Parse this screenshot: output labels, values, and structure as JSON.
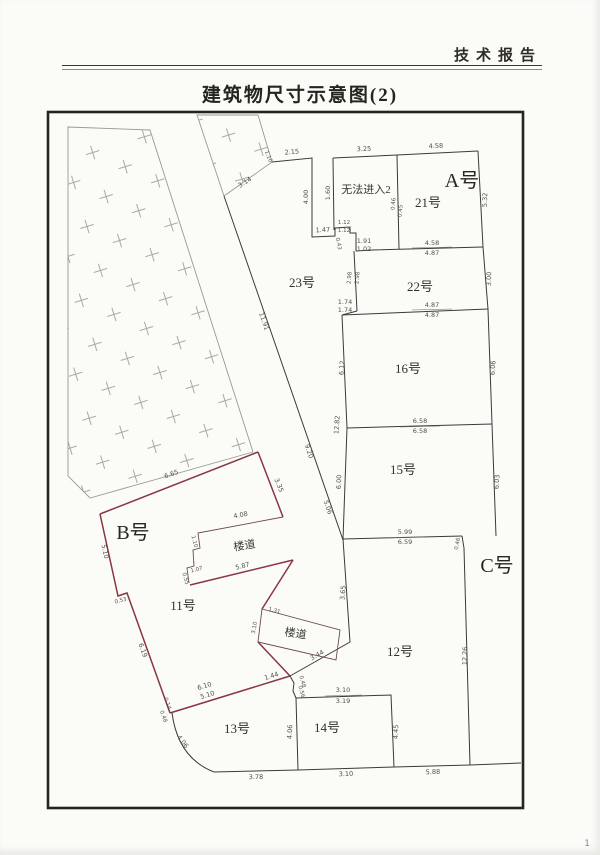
{
  "page": {
    "header": "技术报告",
    "title": "建筑物尺寸示意图(2)",
    "page_number": "1"
  },
  "zones": {
    "a_label": "A号",
    "b_label": "B号",
    "c_label": "C号",
    "no_entry_label": "无法进入2"
  },
  "rooms": {
    "r21": "21号",
    "r22": "22号",
    "r23": "23号",
    "r16": "16号",
    "r15": "15号",
    "r12": "12号",
    "r13": "13号",
    "r14": "14号",
    "r11": "11号",
    "corridor_upper": "楼道",
    "corridor_lower": "楼道"
  },
  "dims": {
    "top_2_15": "2.15",
    "top_1_10": "1.10",
    "hatch_3_14": "3.14",
    "noentry_top_3_25": "3.25",
    "a_top_4_58": "4.58",
    "left_v_4_00": "4.00",
    "noentry_left_1_60": "1.60",
    "step_1_47": "1.47",
    "step_1_12a": "1.12",
    "step_1_12b": "1.12",
    "step_0_43": "0.43",
    "div21_0_46": "0.46",
    "div21_0_45": "0.45",
    "r21_step_1_91": "1.91",
    "r21_step_1_02": "1.02",
    "r21_bot_4_58": "4.58",
    "r21_bot_4_87": "4.87",
    "a_right_5_32": "5.32",
    "r22_left_2_98a": "2.98",
    "r22_left_2_98b": "2.98",
    "r22_step_1_74a": "1.74",
    "r22_step_1_74b": "1.74",
    "r22_bot_4_87a": "4.87",
    "r22_bot_4_87b": "4.87",
    "r22_right_3_00": "3.00",
    "r16_left_6_12": "6.12",
    "left_12_82": "12.82",
    "r16_bot_6_58a": "6.58",
    "r16_bot_6_58b": "6.58",
    "r16_right_6_06": "6.06",
    "r15_left_6_00": "6.00",
    "r15_bot_5_99": "5.99",
    "r15_bot_6_59": "6.59",
    "r15_right_6_03": "6.03",
    "r15_corner_0_46": "0.46",
    "r12_right_12_26": "12.26",
    "r12_left_3_65": "3.65",
    "r12_diag_3_44": "3.44",
    "junction_0_48": "0.48",
    "junction_0_56": "0.56",
    "r14_top_3_10": "3.10",
    "r14_top_3_19": "3.19",
    "r14_left_4_06": "4.06",
    "r14_right_4_45": "4.45",
    "bot_3_78": "3.78",
    "bot_3_10": "3.10",
    "bot_5_88": "5.88",
    "arc_4_06": "4.06",
    "corner_0_14": "0.14",
    "corner_0_48": "0.48",
    "b_top_6_65": "6.65",
    "b_ne_3_35": "3.35",
    "corr1_top_4_08": "4.08",
    "corr1_1_10": "1.10",
    "corr1_1_07": "1.07",
    "corr1_0_55": "0.55",
    "corr1_bot_5_87": "5.87",
    "b_west_5_10": "5.10",
    "b_west_0_53": "0.53",
    "b_west_6_19": "6.19",
    "b_bot_6_10": "6.10",
    "b_bot_5_10": "5.10",
    "b_bot_1_44": "1.44",
    "corr2_1_31": "1.31",
    "corr2_3_10": "3.10",
    "diag_11_91": "11.91",
    "diag_9_20": "9.20",
    "diag_5_06": "5.06"
  },
  "colors": {
    "building_b_outline": "#8a3640",
    "wall_line": "#3c3a38",
    "paper": "#fbfbf8"
  }
}
